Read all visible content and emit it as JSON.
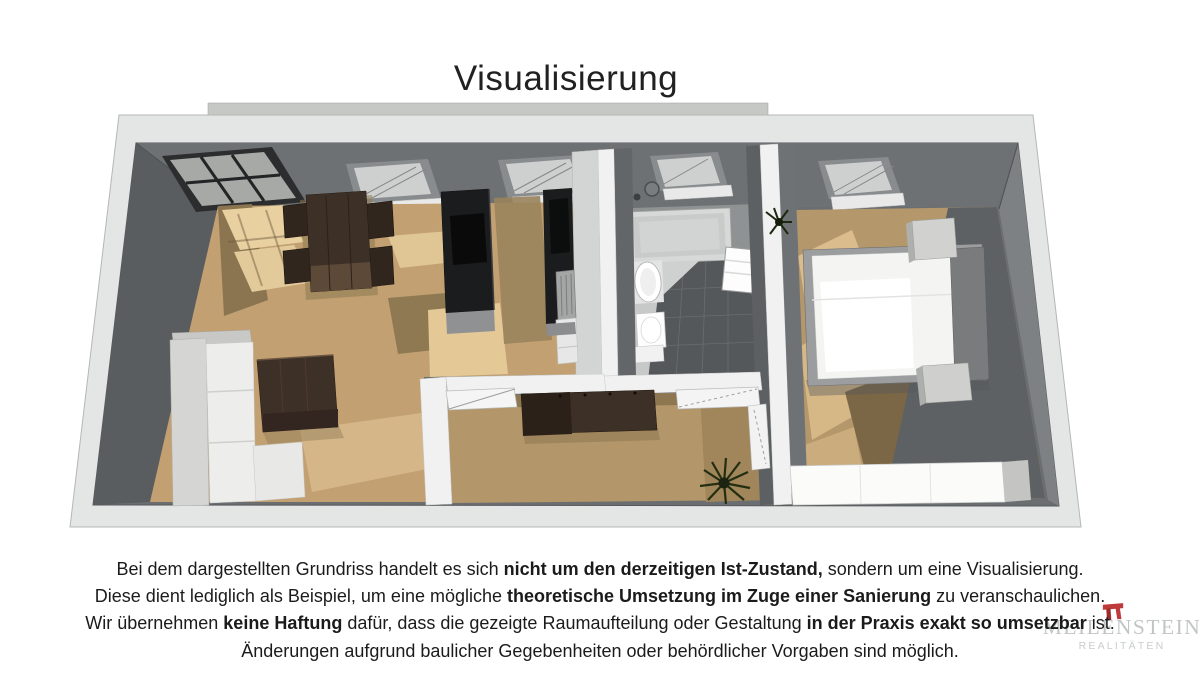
{
  "title": "Visualisierung",
  "disclaimer": {
    "lines": [
      {
        "segments": [
          {
            "t": "Bei dem dargestellten Grundriss handelt es sich ",
            "b": false
          },
          {
            "t": "nicht um den derzeitigen Ist-Zustand,",
            "b": true
          },
          {
            "t": " sondern um eine Visualisierung.",
            "b": false
          }
        ]
      },
      {
        "segments": [
          {
            "t": "Diese dient lediglich als Beispiel, um eine mögliche ",
            "b": false
          },
          {
            "t": "theoretische Umsetzung im Zuge einer Sanierung",
            "b": true
          },
          {
            "t": " zu veranschaulichen.",
            "b": false
          }
        ]
      },
      {
        "segments": [
          {
            "t": "Wir übernehmen ",
            "b": false
          },
          {
            "t": "keine Haftung",
            "b": true
          },
          {
            "t": " dafür, dass die gezeigte Raumaufteilung oder Gestaltung ",
            "b": false
          },
          {
            "t": "in der Praxis exakt so umsetzbar",
            "b": true
          },
          {
            "t": " ist.",
            "b": false
          }
        ]
      },
      {
        "segments": [
          {
            "t": "Änderungen aufgrund baulicher Gegebenheiten oder behördlicher Vorgaben sind möglich.",
            "b": false
          }
        ]
      }
    ]
  },
  "watermark": {
    "brand": "MEILENSTEIN",
    "subtitle": "REALITÄTEN",
    "icon": "milestone-arch-icon",
    "accent_color": "#bf3a3b",
    "accent_dark": "#9e2b2b",
    "text_color": "#c2c5c6"
  },
  "floorplan": {
    "palette": {
      "outer_wall": "#e3e6e4",
      "wall_top": "#6b6e70",
      "wall_dark": "#5a5d5f",
      "wood_floor": "#c2a072",
      "wood_light": "#e6cd9e",
      "wood_shadow": "#8d7852",
      "corridor_floor": "#b3966a",
      "bedroom_wood": "#b4976b",
      "tile_floor": "#54585b",
      "partition_white": "#f0f1f0",
      "kitchen_black": "#1b1c1d",
      "furniture_dark": "#3d3027",
      "sofa_white": "#ededeb",
      "bed_white": "#f4f4f3",
      "wardrobe_white": "#fbfbfa",
      "text": "#1b1b1b"
    }
  }
}
